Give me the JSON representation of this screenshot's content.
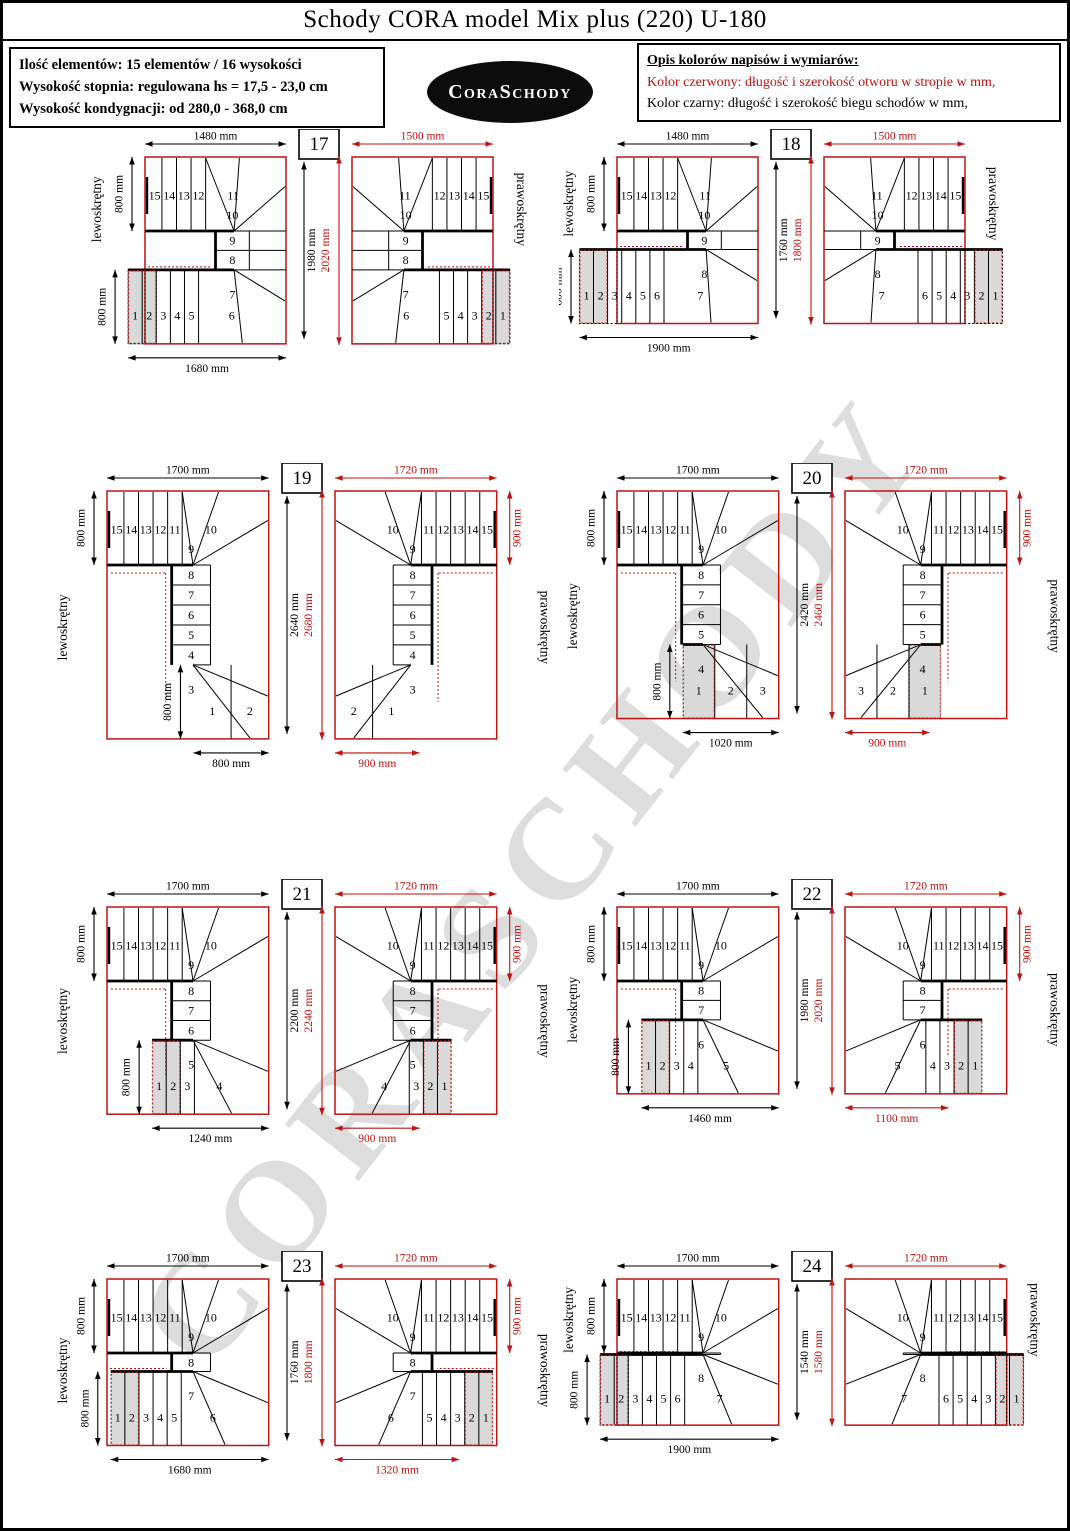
{
  "title": "Schody CORA model Mix plus (220) U-180",
  "info_box": {
    "lines": [
      "Ilość elementów: 15 elementów / 16 wysokości",
      "Wysokość stopnia: regulowana  hs = 17,5 - 23,0 cm",
      "Wysokość kondygnacji: od 280,0 - 368,0 cm"
    ]
  },
  "logo": {
    "text": "CoraSchody"
  },
  "legend": {
    "heading": "Opis kolorów napisów i wymiarów:",
    "red_line": "Kolor czerwony:  długość i szerokość otworu w stropie w mm,",
    "black_line": "Kolor czarny:  długość i szerokość biegu schodów w mm,"
  },
  "watermark": "CORASCHODY",
  "colors": {
    "red": "#c11212",
    "black": "#000000",
    "gray_step": "#d9d9d9"
  },
  "left_label": "lewoskrętny",
  "right_label": "prawoskrętny",
  "panels": [
    {
      "number": "17",
      "dims": {
        "top_black": "1480 mm",
        "top_red": "1500 mm",
        "left_top": "800 mm",
        "left_bottom": "800 mm",
        "mid_black": "1980 mm",
        "mid_red": "2020 mm",
        "bottom_black": "1680 mm",
        "bottom_red": "",
        "right_red": ""
      },
      "mm": {
        "w": 1500,
        "h": 2020,
        "bw": 1680,
        "br": 0
      },
      "steps": {
        "top": [
          15,
          14,
          13,
          12,
          11
        ],
        "col": [
          10,
          9,
          8,
          7
        ],
        "bottom": [
          1,
          2,
          3,
          4,
          5,
          6
        ],
        "gray": 2
      }
    },
    {
      "number": "18",
      "dims": {
        "top_black": "1480 mm",
        "top_red": "1500 mm",
        "left_top": "800 mm",
        "left_bottom": "800 mm",
        "mid_black": "1760 mm",
        "mid_red": "1800 mm",
        "bottom_black": "1900 mm",
        "bottom_red": "",
        "right_red": ""
      },
      "mm": {
        "w": 1500,
        "h": 1800,
        "bw": 1900,
        "br": 0
      },
      "steps": {
        "top": [
          15,
          14,
          13,
          12,
          11
        ],
        "col": [
          10,
          9,
          8
        ],
        "bottom": [
          1,
          2,
          3,
          4,
          5,
          6,
          7
        ],
        "gray": 2
      }
    },
    {
      "number": "19",
      "dims": {
        "top_black": "1700 mm",
        "top_red": "1720 mm",
        "left_top": "800 mm",
        "left_bottom": "800 mm",
        "mid_black": "2640 mm",
        "mid_red": "2680 mm",
        "bottom_black": "800 mm",
        "bottom_red": "900 mm",
        "right_red": "900 mm"
      },
      "mm": {
        "w": 1720,
        "h": 2680,
        "bw": 800,
        "br": 900
      },
      "steps": {
        "top": [
          15,
          14,
          13,
          12,
          11,
          10
        ],
        "col": [
          9,
          8,
          7,
          6,
          5,
          4,
          3
        ],
        "bottom": [
          1,
          2
        ],
        "gray": 0
      }
    },
    {
      "number": "20",
      "dims": {
        "top_black": "1700 mm",
        "top_red": "1720 mm",
        "left_top": "800 mm",
        "left_bottom": "800 mm",
        "mid_black": "2420 mm",
        "mid_red": "2460 mm",
        "bottom_black": "1020 mm",
        "bottom_red": "900 mm",
        "right_red": "900 mm"
      },
      "mm": {
        "w": 1720,
        "h": 2460,
        "bw": 1020,
        "br": 900
      },
      "steps": {
        "top": [
          15,
          14,
          13,
          12,
          11,
          10
        ],
        "col": [
          9,
          8,
          7,
          6,
          5,
          4
        ],
        "bottom": [
          1,
          2,
          3
        ],
        "gray": 1
      }
    },
    {
      "number": "21",
      "dims": {
        "top_black": "1700 mm",
        "top_red": "1720 mm",
        "left_top": "800 mm",
        "left_bottom": "800 mm",
        "mid_black": "2200 mm",
        "mid_red": "2240 mm",
        "bottom_black": "1240 mm",
        "bottom_red": "900 mm",
        "right_red": "900 mm"
      },
      "mm": {
        "w": 1720,
        "h": 2240,
        "bw": 1240,
        "br": 900
      },
      "steps": {
        "top": [
          15,
          14,
          13,
          12,
          11,
          10
        ],
        "col": [
          9,
          8,
          7,
          6,
          5
        ],
        "bottom": [
          1,
          2,
          3,
          4
        ],
        "gray": 2
      }
    },
    {
      "number": "22",
      "dims": {
        "top_black": "1700 mm",
        "top_red": "1720 mm",
        "left_top": "800 mm",
        "left_bottom": "800 mm",
        "mid_black": "1980 mm",
        "mid_red": "2020 mm",
        "bottom_black": "1460 mm",
        "bottom_red": "1100 mm",
        "right_red": "900 mm"
      },
      "mm": {
        "w": 1720,
        "h": 2020,
        "bw": 1460,
        "br": 1100
      },
      "steps": {
        "top": [
          15,
          14,
          13,
          12,
          11,
          10
        ],
        "col": [
          9,
          8,
          7,
          6
        ],
        "bottom": [
          1,
          2,
          3,
          4,
          5
        ],
        "gray": 2
      }
    },
    {
      "number": "23",
      "dims": {
        "top_black": "1700 mm",
        "top_red": "1720 mm",
        "left_top": "800 mm",
        "left_bottom": "800 mm",
        "mid_black": "1760 mm",
        "mid_red": "1800 mm",
        "bottom_black": "1680 mm",
        "bottom_red": "1320 mm",
        "right_red": "900 mm"
      },
      "mm": {
        "w": 1720,
        "h": 1800,
        "bw": 1680,
        "br": 1320
      },
      "steps": {
        "top": [
          15,
          14,
          13,
          12,
          11,
          10
        ],
        "col": [
          9,
          8,
          7
        ],
        "bottom": [
          1,
          2,
          3,
          4,
          5,
          6
        ],
        "gray": 2
      }
    },
    {
      "number": "24",
      "dims": {
        "top_black": "1700 mm",
        "top_red": "1720 mm",
        "left_top": "800 mm",
        "left_bottom": "800 mm",
        "mid_black": "1540 mm",
        "mid_red": "1580 mm",
        "bottom_black": "1900 mm",
        "bottom_red": "",
        "right_red": ""
      },
      "mm": {
        "w": 1720,
        "h": 1580,
        "bw": 1900,
        "br": 0
      },
      "steps": {
        "top": [
          15,
          14,
          13,
          12,
          11,
          10
        ],
        "col": [
          9,
          8
        ],
        "bottom": [
          1,
          2,
          3,
          4,
          5,
          6,
          7
        ],
        "gray": 2
      }
    }
  ]
}
